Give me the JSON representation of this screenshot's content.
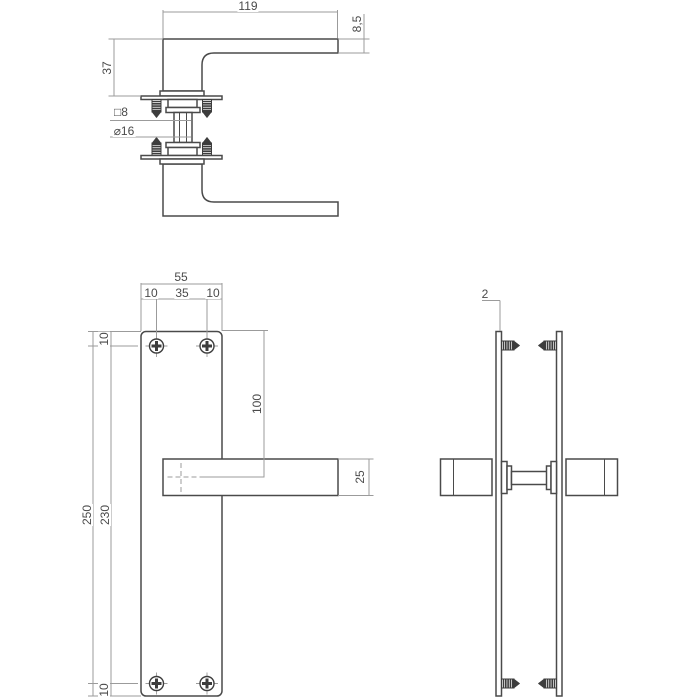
{
  "colors": {
    "background": "#ffffff",
    "object_line": "#4a4a4a",
    "dimension_line": "#9b9b9b",
    "label_text": "#4a4a4a",
    "screw_fill": "#3d3d3d"
  },
  "views": {
    "handle_side": {
      "dims": {
        "length": "119",
        "bar_thickness": "8,5",
        "projection": "37",
        "spindle_square": "□8",
        "neck_diameter": "⌀16"
      }
    },
    "plate_front": {
      "dims": {
        "plate_width": "55",
        "margin_left": "10",
        "screw_spacing": "35",
        "margin_right": "10",
        "margin_top": "10",
        "plate_height": "250",
        "screw_distance": "230",
        "handle_offset": "100",
        "handle_height": "25",
        "margin_bottom": "10"
      }
    },
    "plate_side": {
      "dims": {
        "plate_thickness": "2"
      }
    }
  }
}
